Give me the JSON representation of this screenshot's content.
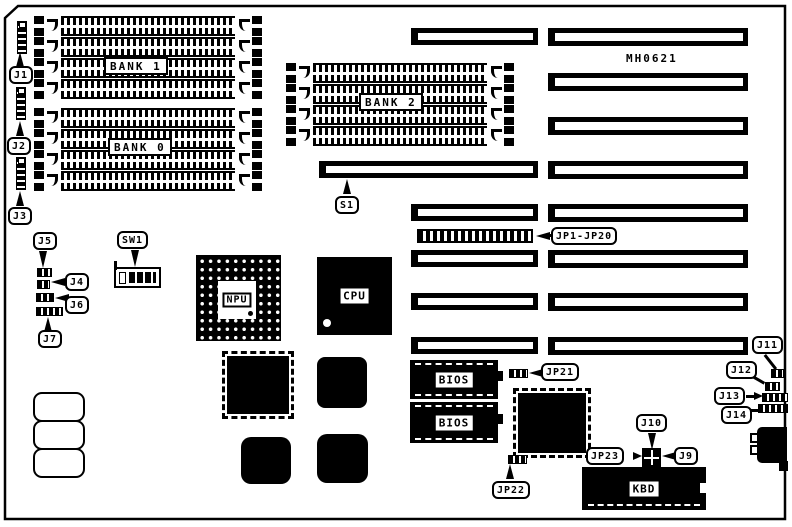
{
  "board": {
    "model_label": "MH0621"
  },
  "banks": {
    "bank1": "BANK 1",
    "bank0": "BANK 0",
    "bank2": "BANK 2"
  },
  "chips": {
    "cpu": "CPU",
    "npu": "NPU",
    "bios": "BIOS",
    "kbd": "KBD"
  },
  "callouts": {
    "j1": "J1",
    "j2": "J2",
    "j3": "J3",
    "j4": "J4",
    "j5": "J5",
    "j6": "J6",
    "j7": "J7",
    "j9": "J9",
    "j10": "J10",
    "j11": "J11",
    "j12": "J12",
    "j13": "J13",
    "j14": "J14",
    "jp1_jp20": "JP1-JP20",
    "jp21": "JP21",
    "jp22": "JP22",
    "jp23": "JP23",
    "s1": "S1",
    "sw1": "SW1"
  },
  "colors": {
    "ink": "#000000",
    "paper": "#ffffff"
  }
}
